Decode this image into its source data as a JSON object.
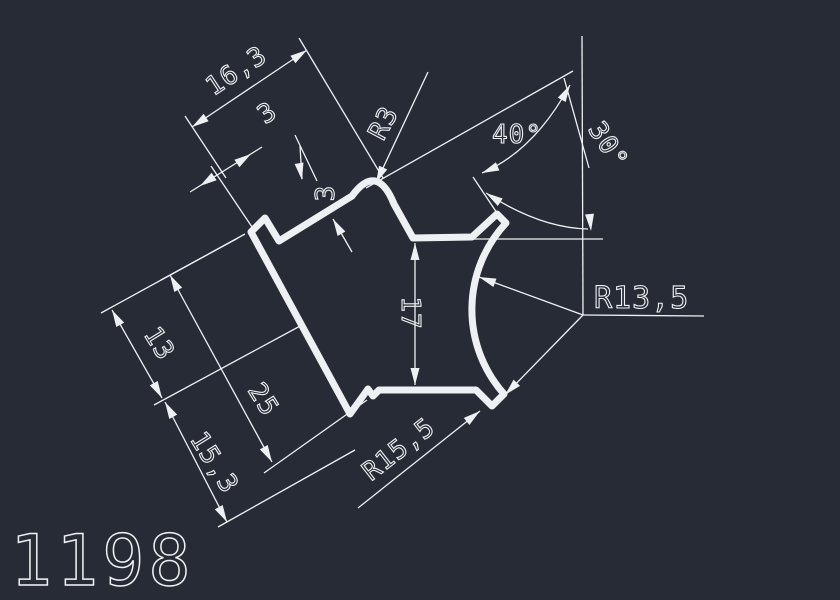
{
  "colors": {
    "background": "#262b35",
    "line": "#eef1f4"
  },
  "drawing_number": "1198",
  "dimensions": {
    "width_total": "16,3",
    "lip_width": "3",
    "lip_depth": "3",
    "top_radius": "R3",
    "angle_top": "40°",
    "angle_vertical": "30°",
    "concave_radius": "R13,5",
    "right_height": "17",
    "left_upper": "13",
    "left_total": "25",
    "left_lower": "15,3",
    "bottom_radius": "R15,5"
  }
}
